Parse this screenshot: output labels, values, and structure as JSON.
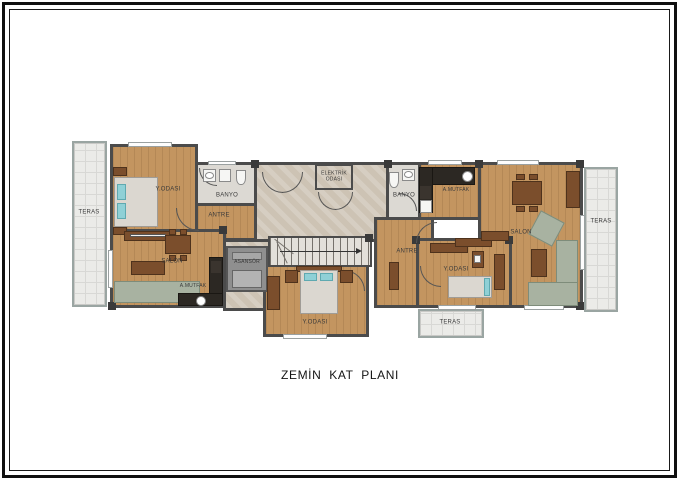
{
  "title": "ZEMİN KAT PLANI",
  "colors": {
    "wall": "#4b4b4b",
    "wood": "#c39560",
    "marble": "#cdc3b4",
    "tile": "#dcd9d3",
    "terrace": "#ebebe8",
    "sofa": "#a8b2a1",
    "furnwood": "#7b4e2c",
    "counter": "#2c2823",
    "pillow": "#8fd0d6",
    "mattress": "#dbd7d0"
  },
  "labels": {
    "teras_left": "TERAS",
    "teras_right": "TERAS",
    "teras_bottom": "TERAS",
    "bedroom_left": "Y.ODASI",
    "bedroom_center": "Y.ODASI",
    "bedroom_right": "Y.ODASI",
    "banyo_left": "BANYO",
    "banyo_right": "BANYO",
    "antre_left": "ANTRE",
    "antre_right": "ANTRE",
    "salon_left": "SALON",
    "salon_right": "SALON",
    "kitchen_left": "A.MUTFAK",
    "kitchen_right": "A.MUTFAK",
    "elektrik": "ELEKTRİK ODASI",
    "asansor": "ASANSÖR"
  }
}
